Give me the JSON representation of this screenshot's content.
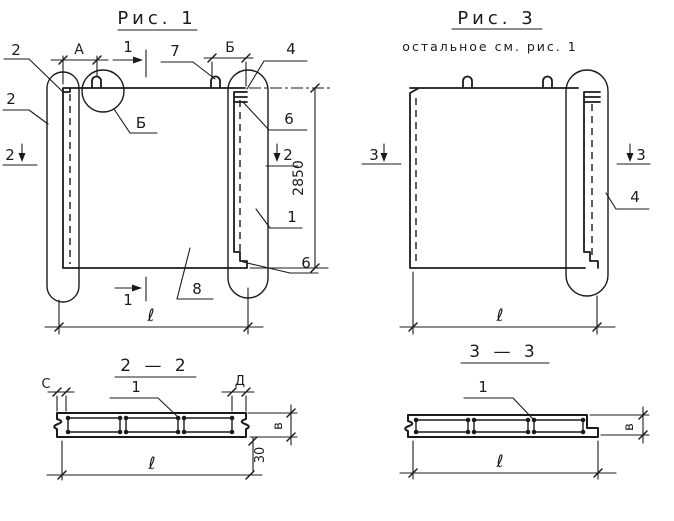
{
  "fig1": {
    "title": "Рис. 1",
    "callout_2_top": "2",
    "callout_2_side": "2",
    "dim_a": "А",
    "section_cut_top": "1",
    "callout_7": "7",
    "dim_b": "Б",
    "callout_4": "4",
    "detail_circle_label": "Б",
    "detail_edge_top": "6",
    "section_left": "2",
    "section_right": "2",
    "dim_height": "2850",
    "callout_1": "1",
    "callout_8": "8",
    "detail_edge_bottom": "6",
    "section_cut_bottom": "1",
    "dim_length": "ℓ"
  },
  "fig3": {
    "title": "Рис. 3",
    "subtitle": "остальное см. рис. 1",
    "section_left": "3",
    "section_right": "3",
    "callout_4": "4",
    "dim_length": "ℓ"
  },
  "section_2_2": {
    "title": "2 — 2",
    "dim_c": "С",
    "dim_d": "Д",
    "callout_1": "1",
    "dim_thickness": "в",
    "dim_offset": "30",
    "dim_length": "ℓ"
  },
  "section_3_3": {
    "title": "3 — 3",
    "callout_1": "1",
    "dim_thickness": "в",
    "dim_length": "ℓ"
  },
  "colors": {
    "ink": "#1b1b1b",
    "paper": "#ffffff"
  }
}
